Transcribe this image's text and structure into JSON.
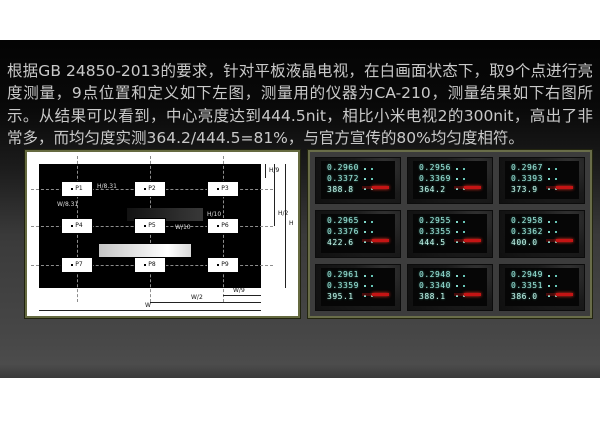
{
  "slide": {
    "paragraph": "根据GB 24850-2013的要求，针对平板液晶电视，在白画面状态下，取9个点进行亮度测量，9点位置和定义如下左图，测量用的仪器为CA-210，测量结果如下右图所示。从结果可以看到，中心亮度达到444.5nit，相比小米电视2的300nit，高出了非常多，而均匀度实测364.2/444.5=81%，与官方宣传的80%均匀度相符。"
  },
  "diagram": {
    "points": [
      "P1",
      "P2",
      "P3",
      "P4",
      "P5",
      "P6",
      "P7",
      "P8",
      "P9"
    ],
    "dims": {
      "h9": "H/9",
      "h2": "H/2",
      "h": "H",
      "w9": "W/9",
      "w2": "W/2",
      "w": "W",
      "box_w": "W/8.31",
      "box_h": "H/8.31",
      "bar_w": "W/10",
      "bar_h": "H/10"
    }
  },
  "meters": {
    "instrument": "CA-210",
    "readings": [
      {
        "x": "0.2960",
        "y": "0.3372",
        "lv": "388.8"
      },
      {
        "x": "0.2956",
        "y": "0.3369",
        "lv": "364.2"
      },
      {
        "x": "0.2967",
        "y": "0.3393",
        "lv": "373.9"
      },
      {
        "x": "0.2965",
        "y": "0.3376",
        "lv": "422.6"
      },
      {
        "x": "0.2955",
        "y": "0.3355",
        "lv": "444.5"
      },
      {
        "x": "0.2958",
        "y": "0.3362",
        "lv": "400.0"
      },
      {
        "x": "0.2961",
        "y": "0.3359",
        "lv": "395.1"
      },
      {
        "x": "0.2948",
        "y": "0.3340",
        "lv": "388.1"
      },
      {
        "x": "0.2949",
        "y": "0.3351",
        "lv": "386.0"
      }
    ]
  },
  "colors": {
    "digit_cyan": "#9ce8dc",
    "indicator_red": "#c41414",
    "frame_olive": "#656a40",
    "slide_bg": "#474747",
    "text_gray": "#c9c9c9"
  }
}
